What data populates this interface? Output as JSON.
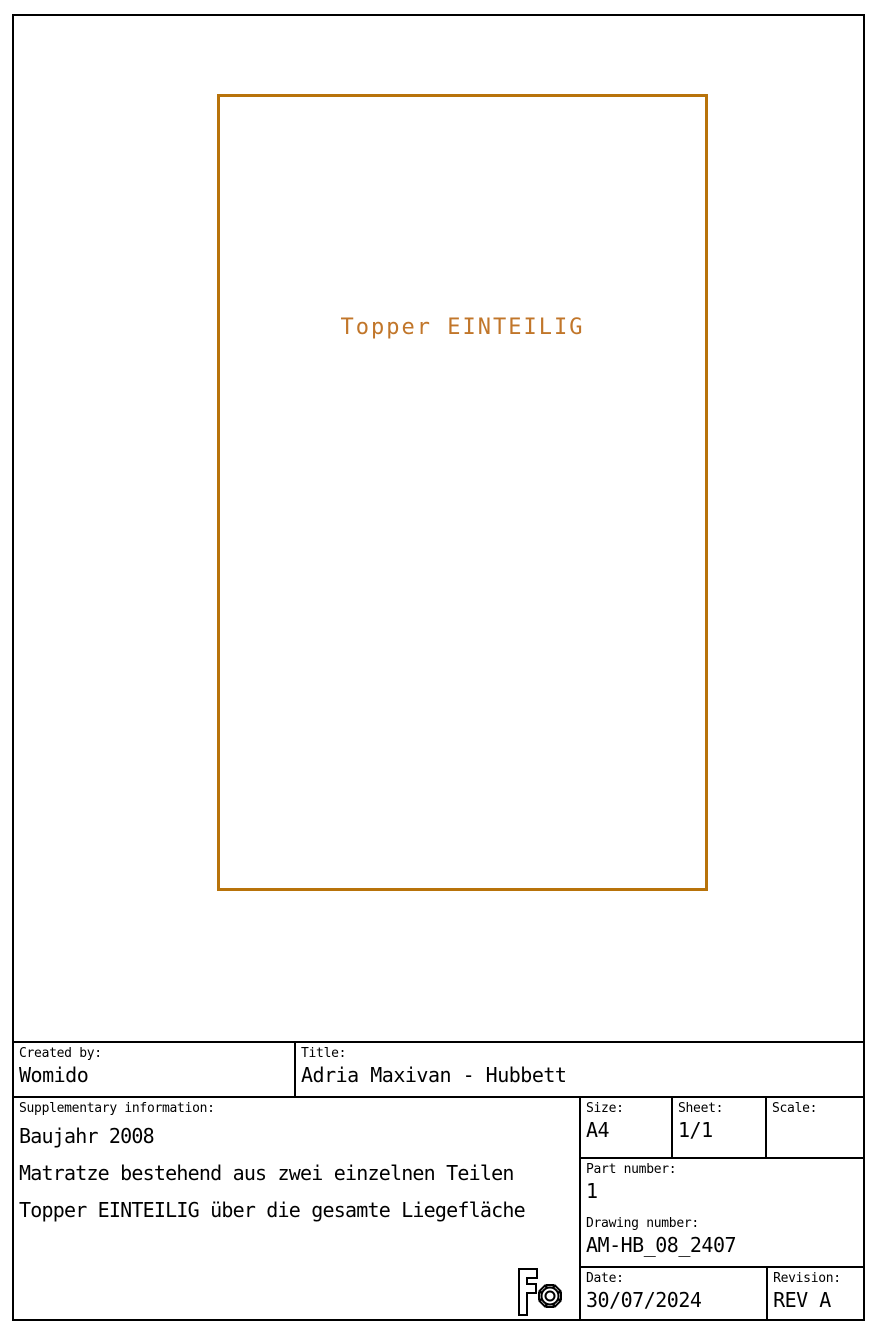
{
  "drawing": {
    "part_label": "Topper EINTEILIG",
    "outline_color": "#b8730a",
    "label_color": "#c1762a"
  },
  "titleblock": {
    "created_by": {
      "label": "Created by:",
      "value": "Womido"
    },
    "title": {
      "label": "Title:",
      "value": "Adria Maxivan - Hubbett"
    },
    "supplementary": {
      "label": "Supplementary information:",
      "lines": [
        "Baujahr 2008",
        "Matratze bestehend aus zwei einzelnen Teilen",
        "Topper EINTEILIG über die gesamte Liegefläche"
      ]
    },
    "size": {
      "label": "Size:",
      "value": "A4"
    },
    "sheet": {
      "label": "Sheet:",
      "value": "1/1"
    },
    "scale": {
      "label": "Scale:",
      "value": ""
    },
    "part_number": {
      "label": "Part number:",
      "value": "1"
    },
    "drawing_number": {
      "label": "Drawing number:",
      "value": "AM-HB_08_2407"
    },
    "date": {
      "label": "Date:",
      "value": "30/07/2024"
    },
    "revision": {
      "label": "Revision:",
      "value": "REV A"
    },
    "logo_icon": "freecad-gear-logo"
  }
}
